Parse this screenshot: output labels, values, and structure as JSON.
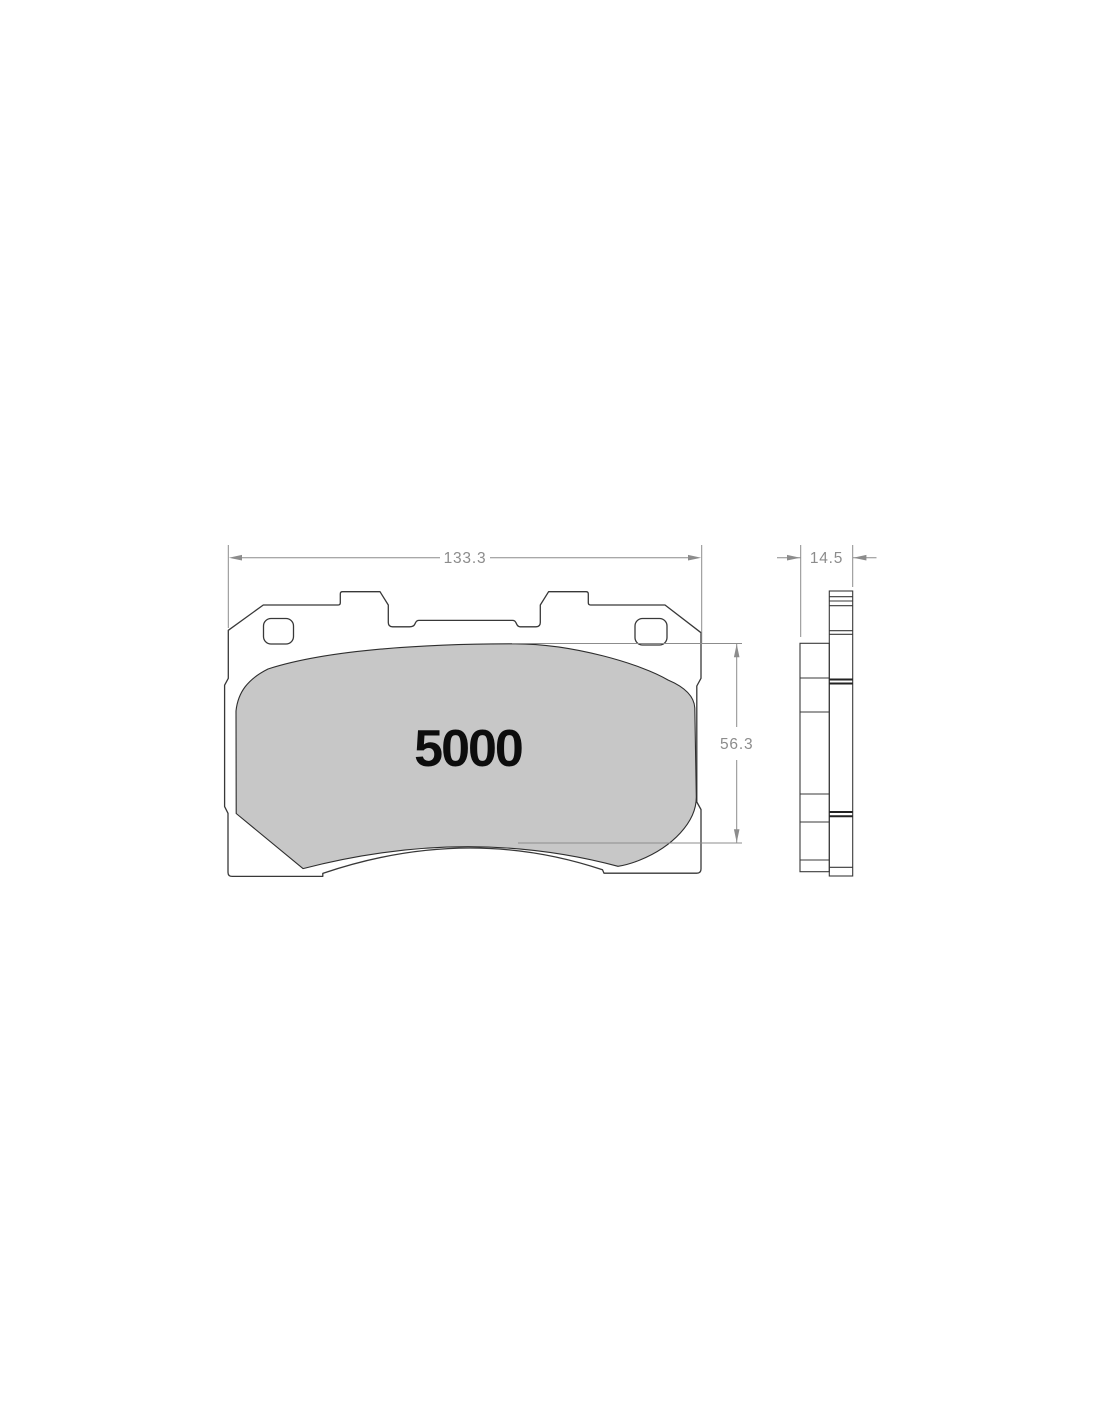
{
  "document": {
    "type": "technical-drawing",
    "subject": "brake-pad",
    "background": "#ffffff"
  },
  "views": {
    "front_view": {
      "part_label": "5000"
    },
    "side_view": {}
  },
  "dimensions": {
    "overall_width": {
      "value": "133.3"
    },
    "thickness": {
      "value": "14.5"
    },
    "pad_height": {
      "value": "56.3"
    }
  },
  "colors": {
    "outline": "#383838",
    "pad_fill": "#c7c7c7",
    "dimension_lines": "#8c8c8c",
    "label_text": "#0d0d0d"
  }
}
